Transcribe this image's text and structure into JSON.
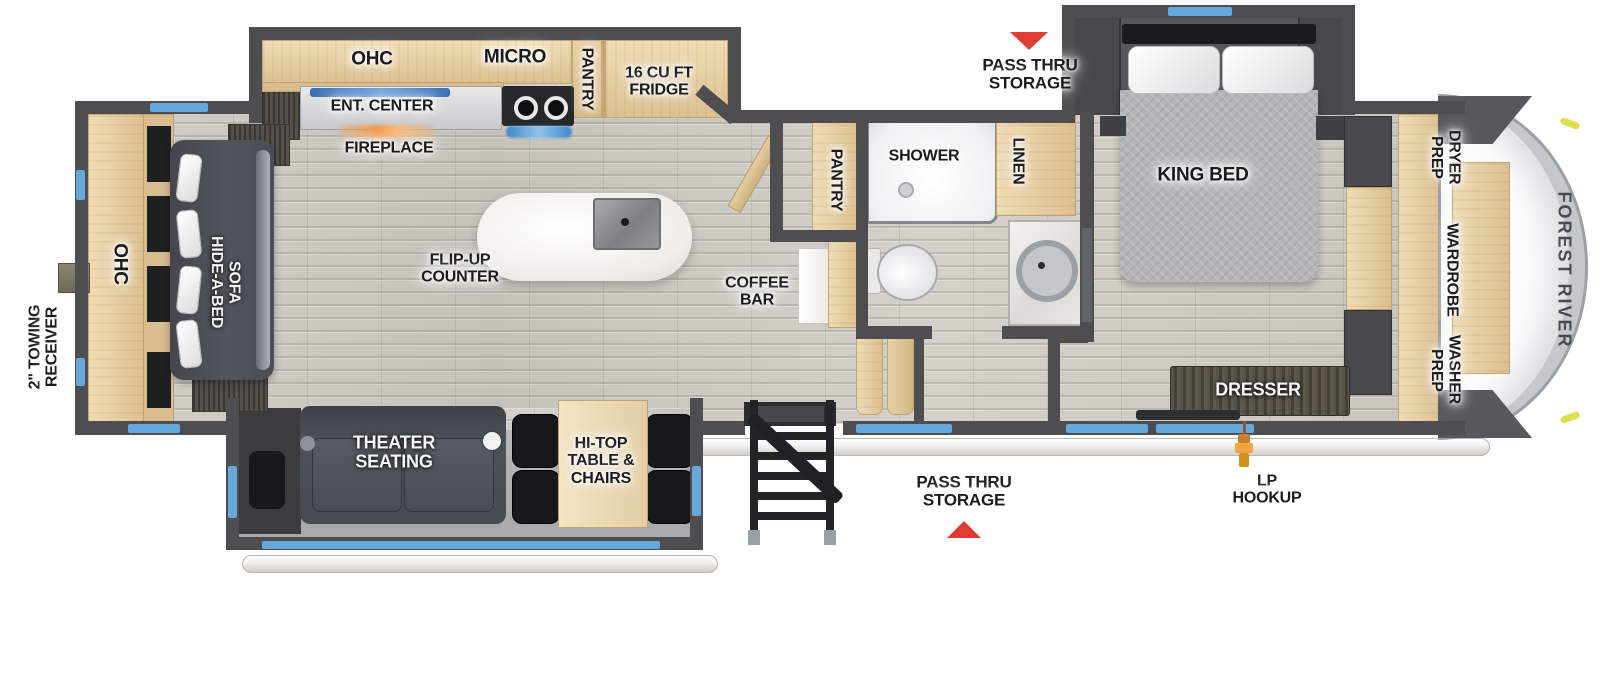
{
  "meta": {
    "title": "Fifth Wheel RV Floor Plan",
    "brand": "FOREST RIVER"
  },
  "colors": {
    "wall": "#4e4e51",
    "floor": "#ccc9c2",
    "cabinet_wood": "#e9d4ab",
    "dark_wood": "#55504a",
    "furniture_dark": "#4b5057",
    "window_blue": "#64a8dc",
    "arrow_red": "#e23b34",
    "fireplace_orange": "#f29a4a",
    "tv_blue": "#4a7fc0",
    "front_cap": "#fbfbfc"
  },
  "labels": {
    "kitchen_ohc": "OHC",
    "micro": "MICRO",
    "kitchen_pantry": "PANTRY",
    "fridge": "16 CU FT FRIDGE",
    "ent_center": "ENT. CENTER",
    "fireplace": "FIREPLACE",
    "flip_up_counter": "FLIP-UP COUNTER",
    "coffee_bar": "COFFEE BAR",
    "bath_pantry": "PANTRY",
    "shower": "SHOWER",
    "linen": "LINEN",
    "king_bed": "KING BED",
    "dresser": "DRESSER",
    "dryer_prep": "DRYER PREP",
    "wardrobe": "WARDROBE",
    "washer_prep": "WASHER PREP",
    "rear_ohc": "OHC",
    "hide_a_bed_sofa": "HIDE-A-BED SOFA",
    "towing_receiver": "2\" TOWING RECEIVER",
    "theater_seating": "THEATER SEATING",
    "hi_top_table": "HI-TOP TABLE & CHAIRS",
    "pass_thru_storage_top": "PASS THRU STORAGE",
    "pass_thru_storage_bottom": "PASS THRU STORAGE",
    "lp_hookup": "LP HOOKUP",
    "brand": "FOREST RIVER"
  }
}
